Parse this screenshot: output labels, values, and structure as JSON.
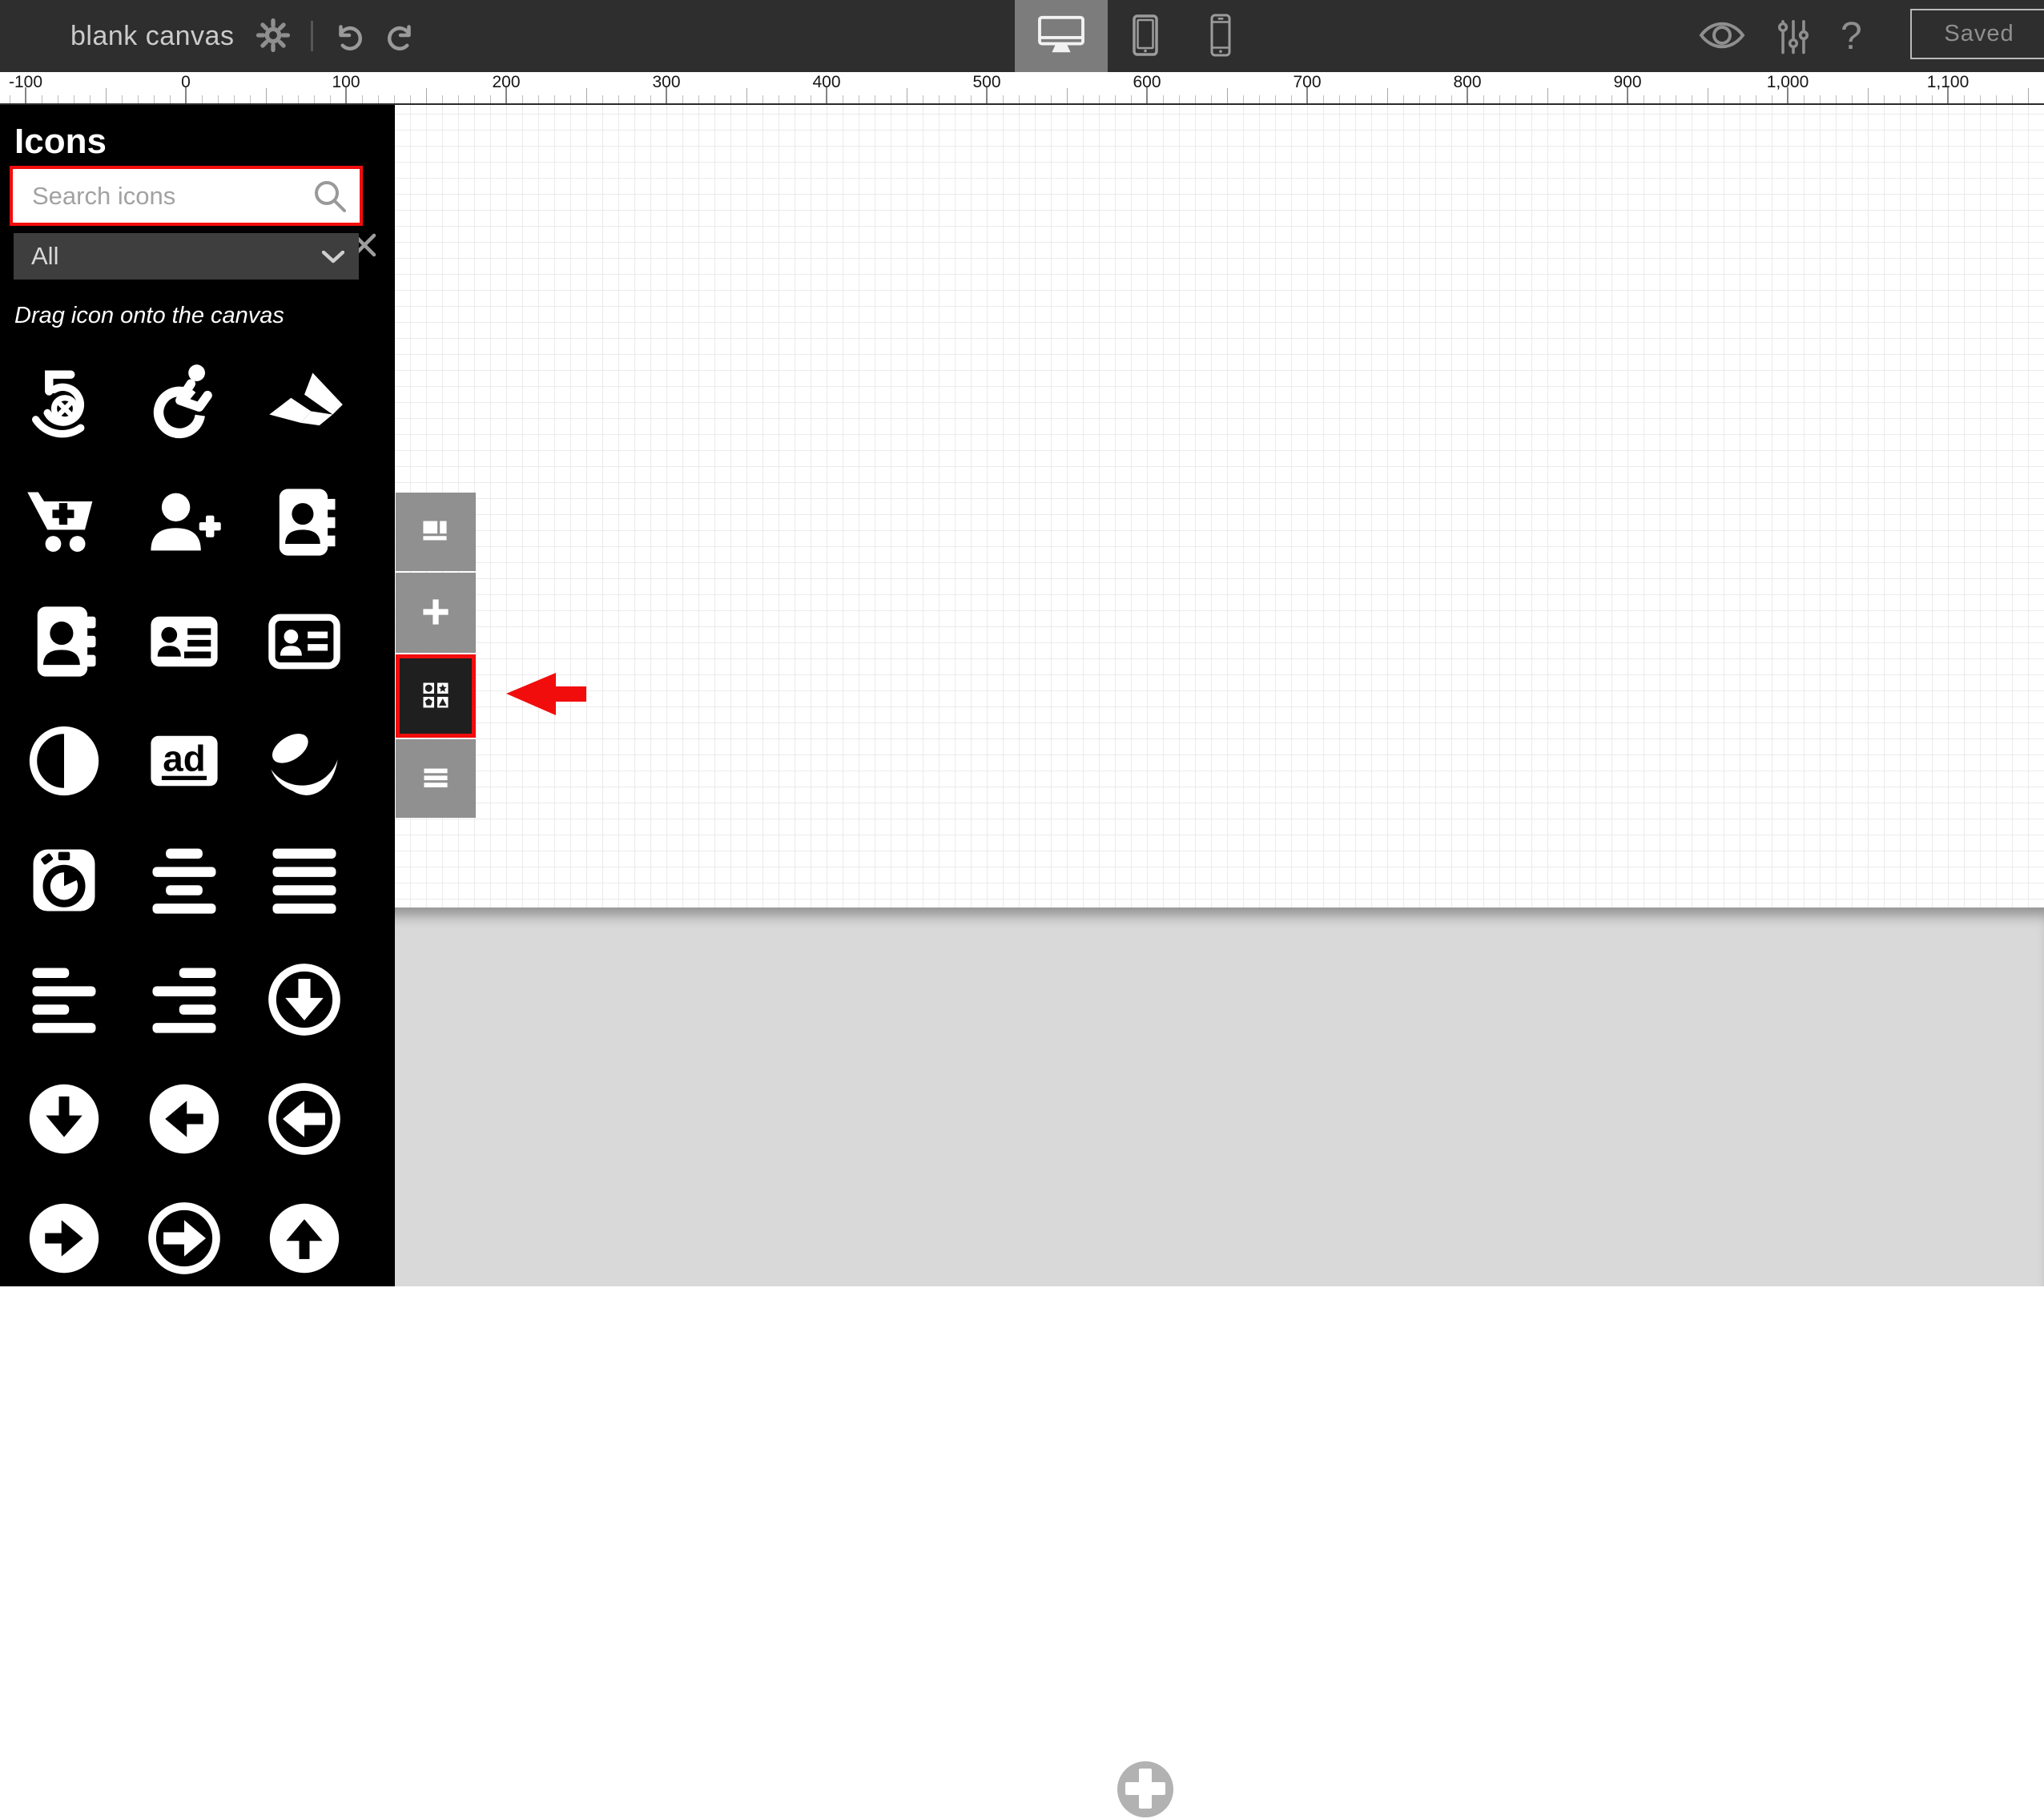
{
  "topbar": {
    "title": "blank canvas",
    "save_button": "Saved",
    "help_glyph": "?",
    "icons": [
      "gear-icon",
      "undo-icon",
      "redo-icon",
      "desktop-icon",
      "tablet-icon",
      "phone-icon",
      "eye-icon",
      "sliders-icon",
      "question-icon"
    ]
  },
  "ruler": {
    "labels": [
      "-100",
      "0",
      "100",
      "200",
      "300",
      "400",
      "500",
      "600",
      "700",
      "800",
      "900",
      "1,000",
      "1,100"
    ]
  },
  "icons_panel": {
    "title": "Icons",
    "search_placeholder": "Search icons",
    "category_value": "All",
    "hint": "Drag icon onto the canvas",
    "close_icon": "close-icon",
    "grid_icons": [
      "500px",
      "accessible",
      "accusoft",
      "cart-plus",
      "user-plus",
      "address-book",
      "address-book-solid",
      "address-card",
      "address-card-outline",
      "adjust",
      "ad",
      "affiliatetheme",
      "stopwatch",
      "align-center",
      "align-justify",
      "align-left",
      "align-right",
      "arrow-alt-circle-down",
      "arrow-circle-down",
      "arrow-circle-left",
      "arrow-alt-circle-left",
      "arrow-circle-right",
      "arrow-alt-circle-right",
      "arrow-circle-up"
    ]
  },
  "canvas_toolbar": {
    "buttons": [
      "pages-layout",
      "add",
      "shapes",
      "menu"
    ],
    "highlighted": "shapes"
  },
  "annotations": {
    "highlight_color": "#f20d0d",
    "items": [
      "search-box-highlight-frame",
      "shapes-button-highlight-frame",
      "red-arrow"
    ]
  },
  "colors": {
    "topbar_bg": "#2e2e2e",
    "panel_bg": "#000000",
    "active_device_bg": "#7c7c7c",
    "toolbar_button_gray": "#909090",
    "offpage_gray": "#d9d9d9",
    "accent_red": "#f20d0d"
  }
}
